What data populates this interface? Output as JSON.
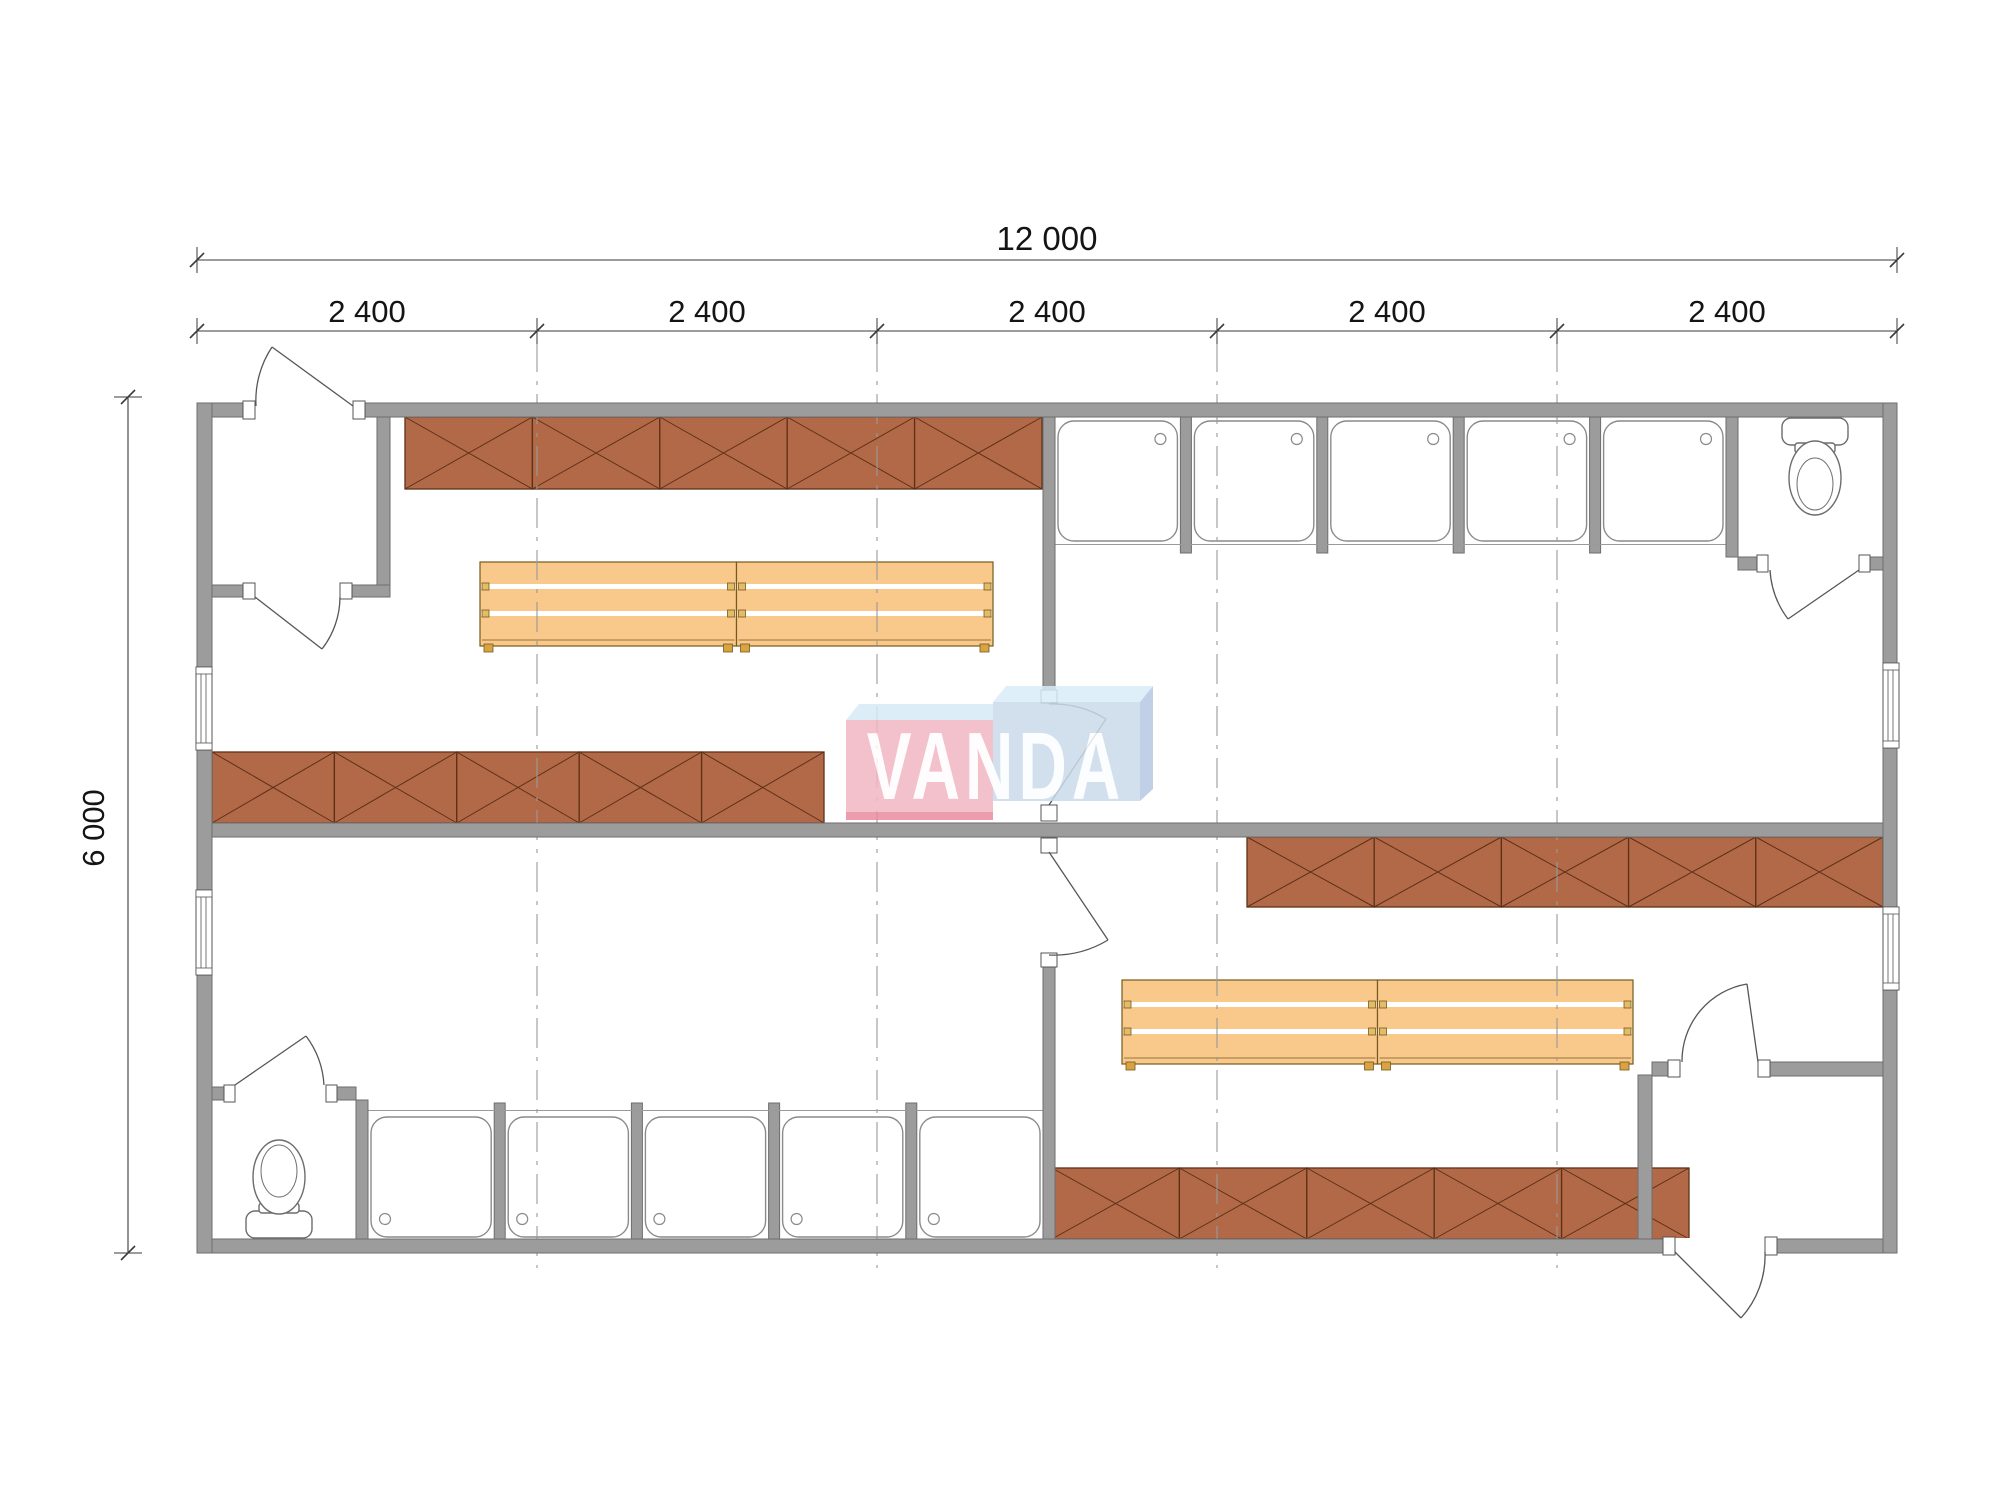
{
  "canvas": {
    "w": 2000,
    "h": 1505,
    "bg": "#ffffff"
  },
  "labels": {
    "total_width": "12 000",
    "building_height": "6 000",
    "modules": [
      "2 400",
      "2 400",
      "2 400",
      "2 400",
      "2 400"
    ]
  },
  "watermark": {
    "text": "VANDA"
  },
  "colors": {
    "wall": "#9c9c9c",
    "wallEdge": "#6e6e6e",
    "locker": "#b26947",
    "lockerEdge": "#5e3018",
    "bench": "#f9c98c",
    "benchEdge": "#77591f",
    "benchTab": "#e3bc67",
    "benchFoot": "#d8a441",
    "stall": "#8a8a8a",
    "dash": "#999999",
    "dim": "#3a3a3a",
    "text": "#141414",
    "logoPink": "#f2b7c3",
    "logoPinkDark": "#eb8ba1",
    "logoBlue": "#cbdbeb",
    "logoBlueTop": "#d9edf9",
    "logoBlueSide": "#b7c8e3",
    "logoPale": "#d7eaf6"
  },
  "inventory": {
    "locker_rows": 4,
    "locker_modules_per_row": 5,
    "bench_groups": 2,
    "benches_per_group": 2,
    "shower_rows": 2,
    "shower_stalls_per_row": 5,
    "toilets": 2,
    "doors": 8,
    "windows": 4
  },
  "lockers": [
    {
      "x": 405,
      "y": 417,
      "w": 637,
      "h": 72,
      "modules": 5
    },
    {
      "x": 212,
      "y": 752,
      "w": 612,
      "h": 71,
      "modules": 5
    },
    {
      "x": 1247,
      "y": 837,
      "w": 636,
      "h": 70,
      "modules": 5
    },
    {
      "x": 1052,
      "y": 1168,
      "w": 637,
      "h": 71,
      "modules": 5
    }
  ],
  "benches": [
    {
      "x": 480,
      "y": 562,
      "w": 513,
      "count": 2
    },
    {
      "x": 1122,
      "y": 980,
      "w": 511,
      "count": 2
    }
  ],
  "showers": [
    {
      "x0": 1055,
      "x1": 1726,
      "wallSide": "top",
      "partY": 417,
      "partH": 136,
      "stallY": 421,
      "stallH": 120,
      "edgeY": 544.5
    },
    {
      "x0": 368,
      "x1": 1043,
      "wallSide": "bottom",
      "partY": 1103,
      "partH": 136,
      "stallY": 1117,
      "stallH": 120,
      "edgeY": 1110.5
    }
  ],
  "windows": [
    {
      "x": 196,
      "y": 667,
      "w": 16,
      "h": 83
    },
    {
      "x": 196,
      "y": 890,
      "w": 16,
      "h": 85
    },
    {
      "x": 1883,
      "y": 663,
      "w": 16,
      "h": 85
    },
    {
      "x": 1883,
      "y": 907,
      "w": 16,
      "h": 83
    }
  ],
  "grid": {
    "xs": [
      537,
      877,
      1217,
      1557
    ],
    "y0": 342,
    "y1": 1268
  },
  "dims": {
    "line1": {
      "y": 260,
      "x0": 197,
      "x1": 1897,
      "ticks": [
        197,
        1897
      ]
    },
    "line2": {
      "y": 331,
      "x0": 197,
      "x1": 1897,
      "ticks": [
        197,
        537,
        877,
        1217,
        1557,
        1897
      ],
      "label_xs": [
        367,
        707,
        1047,
        1387,
        1727
      ],
      "label_y": 322
    },
    "lineV": {
      "x": 128,
      "y0": 397,
      "y1": 1253,
      "ticks": [
        397,
        1253
      ]
    }
  }
}
